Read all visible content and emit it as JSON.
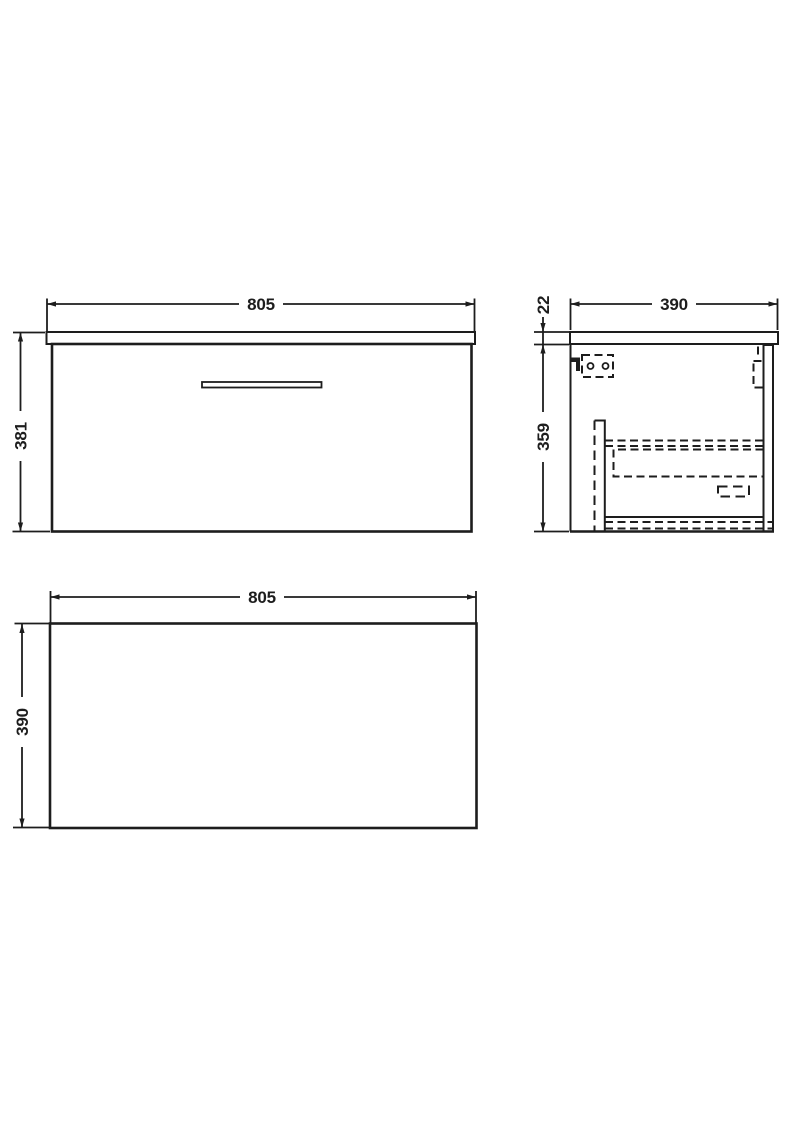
{
  "colors": {
    "background": "#ffffff",
    "line": "#1d1d1d"
  },
  "views": {
    "front": {
      "width_dim": "805",
      "height_dim": "381"
    },
    "side": {
      "depth_dim": "390",
      "worktop_thickness_dim": "22",
      "carcass_height_dim": "359"
    },
    "plan": {
      "width_dim": "805",
      "depth_dim": "390"
    }
  }
}
